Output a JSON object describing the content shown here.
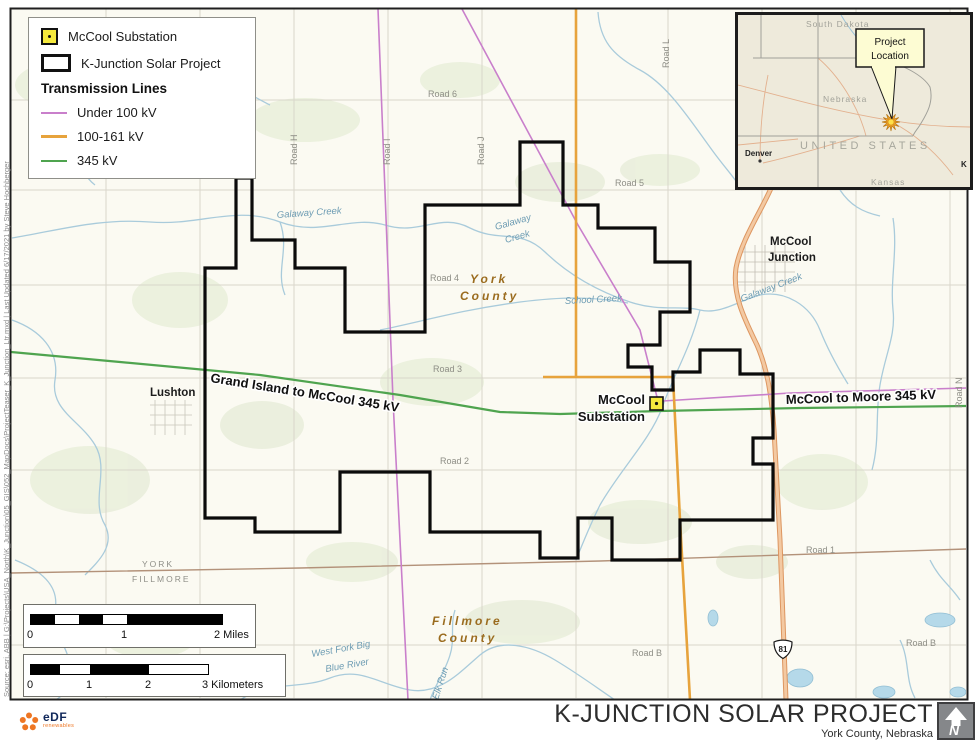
{
  "footer": {
    "title": "K-JUNCTION SOLAR PROJECT",
    "subtitle": "York County, Nebraska",
    "logo_text": "eDF",
    "logo_sub": "renewables",
    "north_letter": "N"
  },
  "source_note": "Source: esri, ABB | G:\\Projects\\USA_North\\K_Junction\\05_GIS\\052_MapDocs\\ProjectTeaser_K_Junction_Ltr.mxd | Last Updated 6/17/2021 by Steve Hochberger",
  "legend": {
    "substation": "McCool Substation",
    "project": "K-Junction Solar Project",
    "transmission_header": "Transmission Lines",
    "under_100": "Under 100 kV",
    "kv_100_161": "100-161 kV",
    "kv_345": "345 kV"
  },
  "colors": {
    "under_100": "#c97fcb",
    "kv_100_161": "#e7a33c",
    "kv_345": "#4fa44f",
    "substation_fill": "#f5e93d",
    "project_boundary": "#0b0b0b",
    "highway": "#f3c9a2",
    "creek": "#a9cbdb",
    "county_line": "#b3927a"
  },
  "inset": {
    "south_dakota": "South Dakota",
    "nebraska": "Nebraska",
    "kansas": "Kansas",
    "denver": "Denver",
    "united_states": "UNITED STATES",
    "partial_city": "K",
    "callout_line1": "Project",
    "callout_line2": "Location"
  },
  "map": {
    "roads": {
      "r6": "Road 6",
      "r5": "Road 5",
      "r4": "Road 4",
      "r3": "Road 3",
      "r2": "Road 2",
      "r1": "Road 1",
      "rb_west": "Road B",
      "rb_east": "Road B",
      "rh": "Road H",
      "ri": "Road I",
      "rj": "Road J",
      "rl": "Road L",
      "rn": "Road N"
    },
    "creeks": {
      "galaway_w": "Galaway Creek",
      "galaway_mid_1": "Galaway",
      "galaway_mid_2": "Creek",
      "galaway_e": "Galaway Creek",
      "school": "School Creek",
      "westfork_1": "West Fork Big",
      "westfork_2": "Blue River",
      "elk_run": "Elk Run"
    },
    "counties": {
      "york_1": "York",
      "york_2": "County",
      "fillmore_1": "Fillmore",
      "fillmore_2": "County",
      "york_caps": "YORK",
      "fillmore_caps": "FILLMORE"
    },
    "towns": {
      "lushton": "Lushton",
      "mccool_1": "McCool",
      "mccool_2": "Junction"
    },
    "transmission": {
      "grand_island": "Grand Island to McCool 345 kV",
      "mccool_moore": "McCool to Moore 345 kV"
    },
    "substation": {
      "line1": "McCool",
      "line2": "Substation"
    },
    "highway_shield": "81"
  },
  "scalebars": {
    "miles": {
      "t0": "0",
      "t1": "1",
      "t2": "2 Miles"
    },
    "km": {
      "t0": "0",
      "t1": "1",
      "t2": "2",
      "t3": "3 Kilometers"
    }
  }
}
